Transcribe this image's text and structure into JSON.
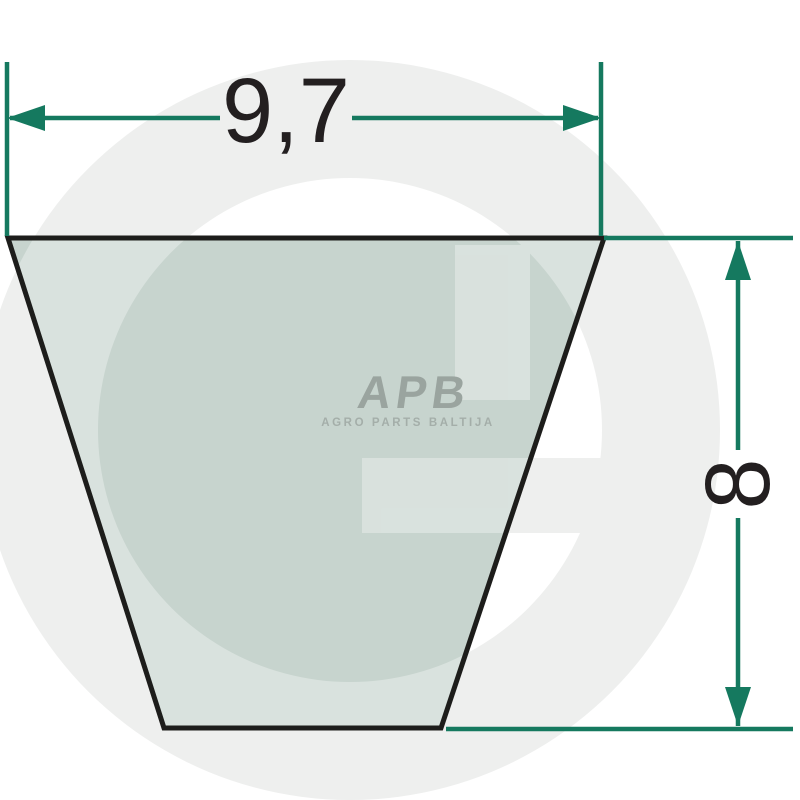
{
  "page": {
    "title": "V-belt cross-section dimension drawing"
  },
  "diagram": {
    "width_dimension": {
      "value": "9,7"
    },
    "height_dimension": {
      "value": "8"
    },
    "logo": {
      "abbr": "APB",
      "subtitle": "AGRO PARTS BALTIJA"
    },
    "watermark": {
      "letter": "G"
    },
    "colors": {
      "dimension_line": "#15795f",
      "belt_fill": "#c7d4ce",
      "belt_outline": "#1d1d1b",
      "logo_gray": "#9aa49f",
      "logo_sub_gray": "#a4aea9",
      "watermark_gray": "#eeefee",
      "text": "#231f20",
      "background": "#ffffff"
    }
  }
}
